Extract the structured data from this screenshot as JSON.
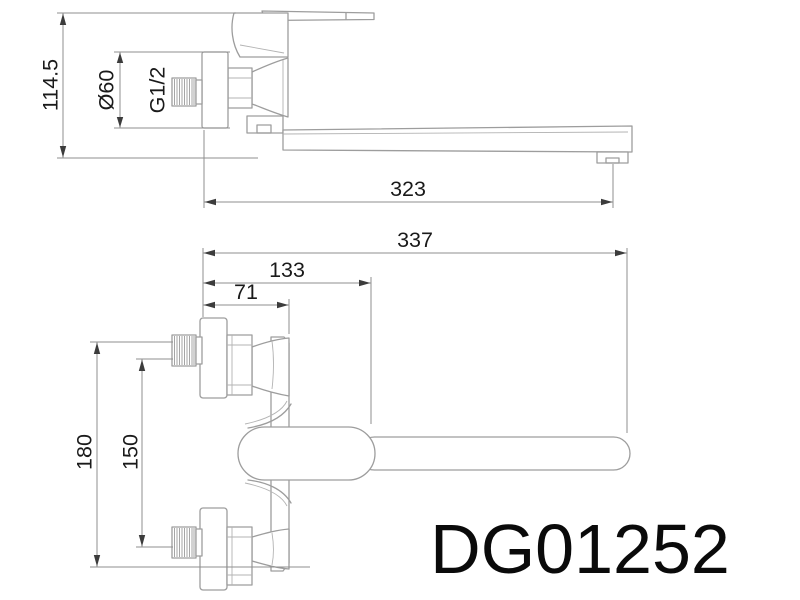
{
  "product": {
    "code": "DG01252"
  },
  "dims": {
    "side_overall_height": "114.5",
    "escutcheon_diameter": "Ø60",
    "thread_size": "G1/2",
    "wall_to_spout_outlet": "323",
    "front_overall_length": "337",
    "wall_to_body_end": "133",
    "wall_to_bracket_edge": "71",
    "front_overall_height": "180",
    "inlet_centre_distance": "150"
  },
  "colors": {
    "background": "#ffffff",
    "part_line": "#9d9d9d",
    "dimension_line": "#8f8f8f",
    "arrow": "#3c3c3c",
    "text": "#1a1a1a"
  }
}
